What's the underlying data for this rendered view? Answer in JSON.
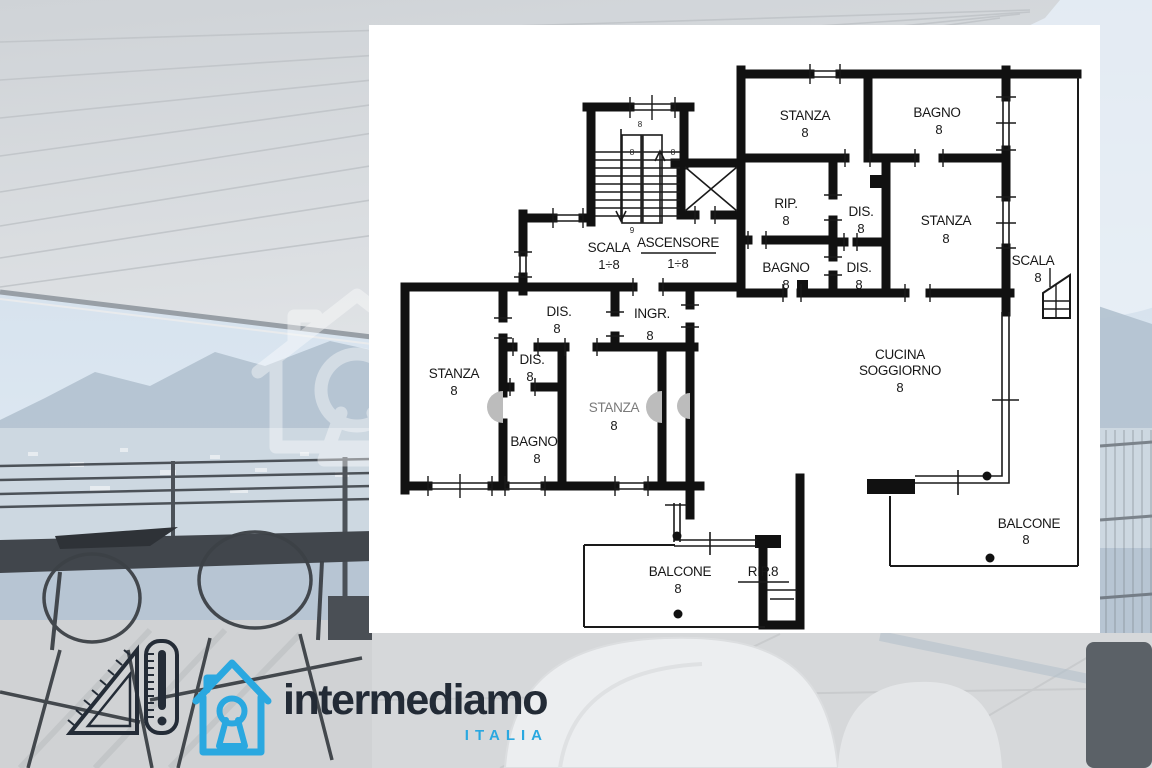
{
  "colors": {
    "plan_ink": "#111111",
    "brand_navy": "#232b36",
    "brand_blue": "#2aa8e0"
  },
  "brand": {
    "wordmark": "intermediamo",
    "country": "ITALIA"
  },
  "floorplan": {
    "stairwell": {
      "scala": {
        "label": "SCALA",
        "floors": "1÷8"
      },
      "ascensore": {
        "label": "ASCENSORE",
        "floors": "1÷8"
      },
      "marks": [
        "8",
        "8",
        "8",
        "9"
      ]
    },
    "rooms": {
      "stanza_nw": {
        "label": "STANZA",
        "area": "8"
      },
      "bagno_ne": {
        "label": "BAGNO",
        "area": "8"
      },
      "rip": {
        "label": "RIP.",
        "area": "8"
      },
      "dis_upper": {
        "label": "DIS.",
        "area": "8"
      },
      "stanza_e": {
        "label": "STANZA",
        "area": "8"
      },
      "bagno_c": {
        "label": "BAGNO",
        "area": "8"
      },
      "dis_lower": {
        "label": "DIS.",
        "area": "8"
      },
      "scala_ext": {
        "label": "SCALA",
        "area": "8"
      },
      "cucina": {
        "line1": "CUCINA",
        "line2": "SOGGIORNO",
        "area": "8"
      },
      "stanza_w": {
        "label": "STANZA",
        "area": "8"
      },
      "dis_w1": {
        "label": "DIS.",
        "area": "8"
      },
      "dis_w2": {
        "label": "DIS.",
        "area": "8"
      },
      "bagno_w": {
        "label": "BAGNO",
        "area": "8"
      },
      "stanza_c": {
        "label": "STANZA",
        "area": "8"
      },
      "ingresso": {
        "label": "INGR.",
        "area": "8"
      },
      "balcone_s": {
        "label": "BALCONE",
        "area": "8"
      },
      "rip_s": {
        "label": "RIP.8"
      },
      "balcone_e": {
        "label": "BALCONE",
        "area": "8"
      }
    }
  }
}
